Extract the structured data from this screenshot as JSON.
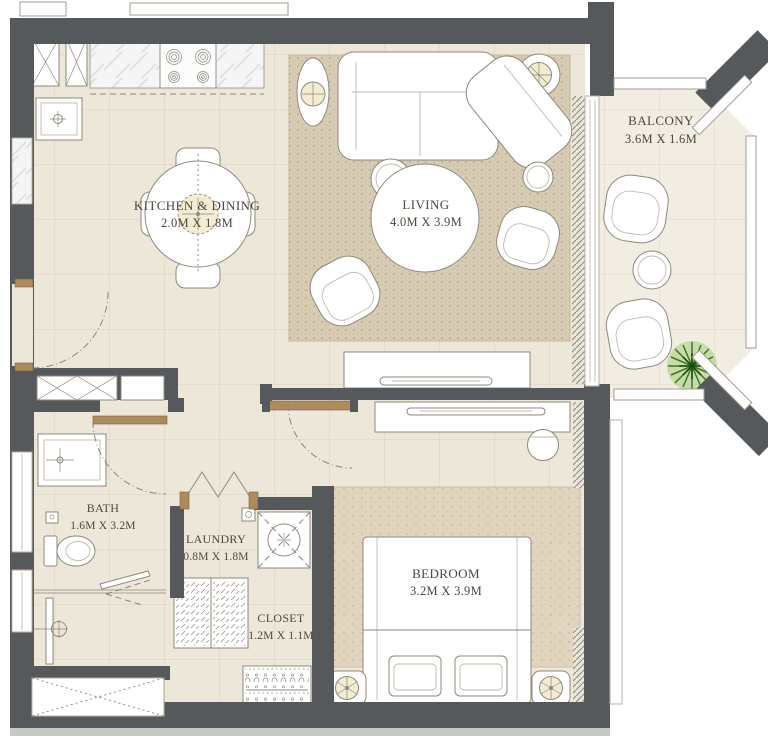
{
  "plan": {
    "type": "apartment-floor-plan",
    "rooms": [
      {
        "id": "kitchen-dining",
        "name": "KITCHEN & DINING",
        "dims": "2.0M X 1.8M"
      },
      {
        "id": "living",
        "name": "LIVING",
        "dims": "4.0M X 3.9M"
      },
      {
        "id": "balcony",
        "name": "BALCONY",
        "dims": "3.6M X 1.6M"
      },
      {
        "id": "bath",
        "name": "BATH",
        "dims": "1.6M X 3.2M"
      },
      {
        "id": "laundry",
        "name": "LAUNDRY",
        "dims": "0.8M X 1.8M"
      },
      {
        "id": "closet",
        "name": "CLOSET",
        "dims": "1.2M X 1.1M"
      },
      {
        "id": "bedroom",
        "name": "BEDROOM",
        "dims": "3.2M X 3.9M"
      }
    ],
    "colors": {
      "wall": "#55595c",
      "floor": "#ede7d9",
      "balcony_floor": "#f2ede2",
      "living_rug": "#d8cbb4",
      "bedroom_rug": "#e1d5c0",
      "outline": "#8f897c",
      "wood": "#ae8b5c",
      "plant_green": "#2e6b1b",
      "lamp_tint": "#f2ecd2",
      "label_text": "#4e463c"
    },
    "fixtures": [
      "refrigerator",
      "kitchen-cabinet",
      "cooktop",
      "kitchen-counter",
      "kitchen-sink",
      "dining-table",
      "dining-chair",
      "pendant-light",
      "sectional-sofa",
      "chaise",
      "floor-plant",
      "coffee-table",
      "side-table",
      "armchair",
      "tv-console",
      "tv",
      "sliding-door",
      "desk",
      "desk-chair",
      "bed",
      "pillow",
      "nightstand",
      "table-lamp",
      "vanity-sink",
      "toilet",
      "shower",
      "washing-machine",
      "bifold-door",
      "wardrobe",
      "hanger-rail",
      "balcony-chair",
      "balcony-table",
      "potted-plant",
      "railing",
      "entry-door",
      "bath-door",
      "bedroom-door",
      "service-shaft"
    ]
  }
}
